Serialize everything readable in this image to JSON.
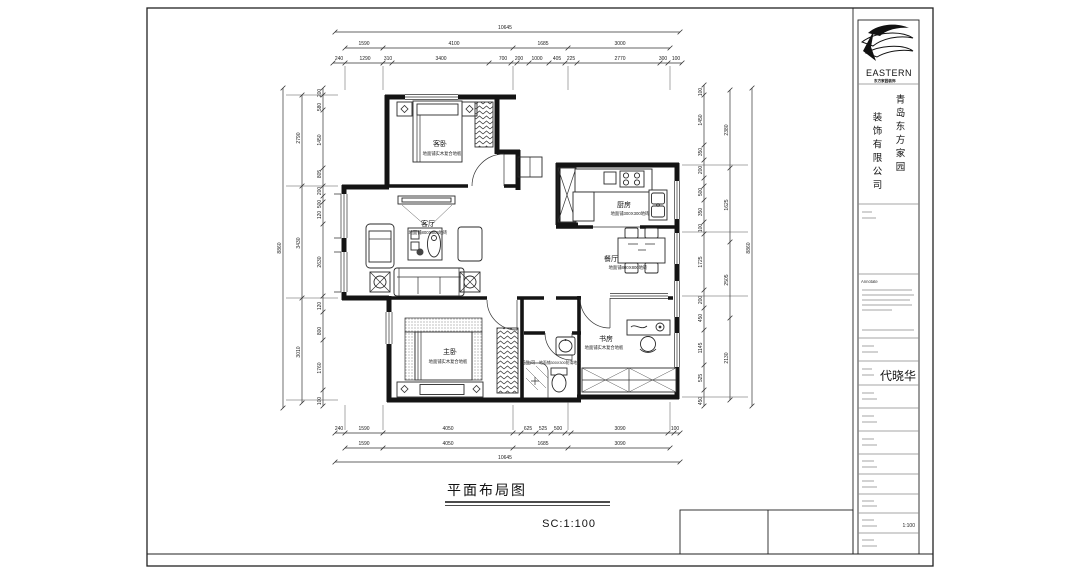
{
  "frame": {
    "drawing_title": "平面布局图",
    "scale_label": "SC:1:100"
  },
  "title_block": {
    "brand": "EASTERN",
    "brand_sub": "东方家园装饰",
    "company_line1": "青岛东方家园",
    "company_line2": "装饰有限公司",
    "annotate_label": "Annotate",
    "designer_name": "代晓华",
    "scale_value": "1:100"
  },
  "rooms": {
    "guest_bedroom": {
      "name": "客卧",
      "note": "地面铺实木复合地板"
    },
    "living": {
      "name": "客厅",
      "note": "地面铺800X800地砖"
    },
    "kitchen": {
      "name": "厨房",
      "note": "地面铺300X300地砖"
    },
    "dining": {
      "name": "餐厅",
      "note": "地面铺800X800地砖"
    },
    "master_bedroom": {
      "name": "主卧",
      "note": "地面铺实木复合地板"
    },
    "study": {
      "name": "书房",
      "note": "地面铺实木复合地板"
    },
    "bathroom": {
      "name": "卫生间",
      "note": "地面铺300X300防滑地砖"
    }
  },
  "dims": {
    "top": {
      "total": "10645",
      "mid": [
        "1590",
        "4100",
        "1685",
        "3000"
      ],
      "inner": [
        "240",
        "1290",
        "310",
        "3400",
        "700",
        "200",
        "1000",
        "405",
        "225",
        "2770",
        "300",
        "100"
      ]
    },
    "bottom": {
      "total": "10645",
      "mid": [
        "1590",
        "4050",
        "1685",
        "3090"
      ],
      "inner": [
        "240",
        "1590",
        "4050",
        "625",
        "525",
        "500",
        "3090",
        "100"
      ]
    },
    "left": {
      "total": "8860",
      "mid": [
        "2790",
        "3430",
        "3010"
      ],
      "inner": [
        "200",
        "580",
        "1450",
        "805",
        "200",
        "500",
        "120",
        "2630",
        "120",
        "800",
        "1760",
        "100"
      ]
    },
    "right": {
      "total": "8860",
      "mid": [
        "2380",
        "1625",
        "2505",
        "2130"
      ],
      "inner": [
        "100",
        "1450",
        "350",
        "200",
        "500",
        "350",
        "100",
        "1725",
        "200",
        "450",
        "1145",
        "525",
        "450"
      ]
    }
  }
}
